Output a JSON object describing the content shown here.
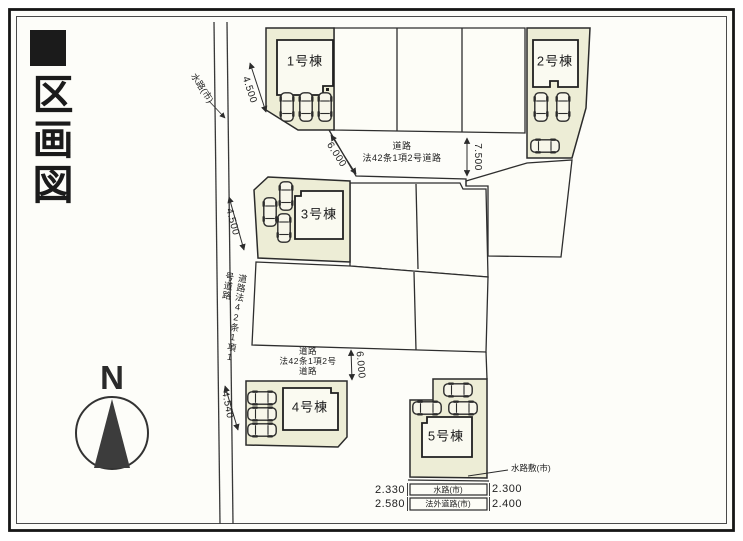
{
  "title": {
    "text": "区画図"
  },
  "compass": {
    "north_label": "N"
  },
  "plan": {
    "waterway_label": "水路(市)",
    "waterway_bed_label": "水路敷(市)",
    "left_road_label": "道路法42条1項1号道路",
    "left_road_dims": [
      "4.500",
      "4.500",
      "4.540"
    ],
    "top_road": {
      "line1": "道路",
      "line2": "法42条1項2号道路",
      "width_dim": "6.000",
      "end_dim": "7.500"
    },
    "middle_road": {
      "line1": "道路",
      "line2": "法42条1項2号",
      "line3": "道路",
      "width_dim": "6.000"
    },
    "buildings": [
      {
        "name": "1号棟"
      },
      {
        "name": "2号棟"
      },
      {
        "name": "3号棟"
      },
      {
        "name": "4号棟"
      },
      {
        "name": "5号棟"
      }
    ],
    "bottom_strips": [
      {
        "left_dim": "2.330",
        "label": "水路(市)",
        "right_dim": "2.300"
      },
      {
        "left_dim": "2.580",
        "label": "法外道路(市)",
        "right_dim": "2.400"
      }
    ]
  }
}
